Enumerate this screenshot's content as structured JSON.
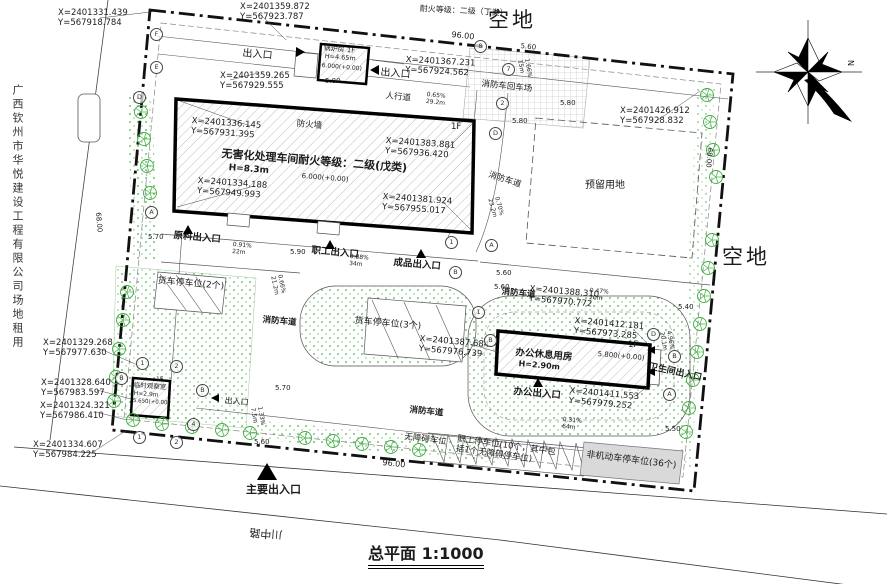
{
  "meta": {
    "scale": "1:1000"
  },
  "colors": {
    "line": "#1a1a1a",
    "tree_green": "#3fae3f",
    "grass_dot": "#4caf50",
    "gray_parking": "#d9d9d9",
    "hatch": "#adadad"
  },
  "icons": [
    "north-compass-icon",
    "entrance-arrow-icon",
    "tree-icon",
    "axis-bubble-icon"
  ],
  "texts": [
    {
      "n": "coord-top-left",
      "t": "X=2401331.439\nY=567918.784",
      "x": 58,
      "y": 8,
      "s": 8.5
    },
    {
      "n": "coord-top-2",
      "t": "X=2401359.872\nY=567923.787",
      "x": 240,
      "y": 2,
      "s": 8.5
    },
    {
      "n": "fire-rating-note",
      "t": "耐火等级：二级（丁类）",
      "x": 420,
      "y": 4,
      "s": 8,
      "r": 3
    },
    {
      "n": "vacant-land-top",
      "t": "空地",
      "x": 488,
      "y": 8,
      "s": 21,
      "sp": 3
    },
    {
      "n": "dim-96-top",
      "t": "96.00",
      "x": 452,
      "y": 30,
      "s": 8,
      "r": 6
    },
    {
      "n": "dim-560-top",
      "t": "5.60",
      "x": 521,
      "y": 42,
      "s": 7,
      "r": 6
    },
    {
      "n": "entrance-nw-label",
      "t": "出入口",
      "x": 243,
      "y": 48,
      "s": 10,
      "r": 5
    },
    {
      "n": "boiler-name",
      "t": "锅炉房 1F",
      "x": 324,
      "y": 44,
      "s": 7,
      "r": 5
    },
    {
      "n": "boiler-height",
      "t": "H=4.65m",
      "x": 325,
      "y": 53,
      "s": 6.5,
      "r": 5
    },
    {
      "n": "boiler-elevation",
      "t": "6.000(+0.00)",
      "x": 322,
      "y": 62,
      "s": 6,
      "r": 5
    },
    {
      "n": "coord-boiler",
      "t": "X=2401367.231\nY=567924.562",
      "x": 406,
      "y": 55,
      "s": 8.5,
      "r": 3
    },
    {
      "n": "entrance-n2-label",
      "t": "出入口",
      "x": 381,
      "y": 67,
      "s": 10,
      "r": 5
    },
    {
      "n": "fire-truck-turnaround",
      "t": "消防车回车场",
      "x": 482,
      "y": 79,
      "s": 8.5,
      "r": 6
    },
    {
      "n": "walkway-label",
      "t": "人行道",
      "x": 386,
      "y": 91,
      "s": 8.5,
      "r": 6
    },
    {
      "n": "slope-walkway",
      "t": "0.65%\n29.2m",
      "x": 427,
      "y": 91,
      "s": 6,
      "r": 6
    },
    {
      "n": "coord-axis-d",
      "t": "X=2401359.265\nY=567929.555",
      "x": 220,
      "y": 71,
      "s": 8.5
    },
    {
      "n": "dim-580-a",
      "t": "5.80",
      "x": 325,
      "y": 77,
      "s": 7
    },
    {
      "n": "dim-580-b",
      "t": "5.80",
      "x": 560,
      "y": 99,
      "s": 7
    },
    {
      "n": "dim-580-c",
      "t": "5.80",
      "x": 512,
      "y": 117,
      "s": 7
    },
    {
      "n": "slope-turnaround",
      "t": "1.66%\n15m",
      "x": 530,
      "y": 58,
      "s": 6,
      "r": 80
    },
    {
      "n": "firewall-label",
      "t": "防火墙",
      "x": 297,
      "y": 119,
      "s": 8.5,
      "r": 5
    },
    {
      "n": "main-building-floor",
      "t": "1F",
      "x": 451,
      "y": 122,
      "s": 8.5
    },
    {
      "n": "coord-main-1",
      "t": "X=2401336.145\nY=567931.395",
      "x": 192,
      "y": 116,
      "s": 8.5,
      "r": 4
    },
    {
      "n": "main-building-name",
      "t": "无害化处理车间耐火等级：二级(戊类)",
      "x": 222,
      "y": 148,
      "s": 11,
      "r": 4.5,
      "b": 1
    },
    {
      "n": "main-building-height",
      "t": "H=8.3m",
      "x": 229,
      "y": 163,
      "s": 9,
      "r": 4.5,
      "b": 1
    },
    {
      "n": "main-building-elevation",
      "t": "6.000(+0.00)",
      "x": 302,
      "y": 172,
      "s": 7,
      "r": 4.5
    },
    {
      "n": "coord-main-2",
      "t": "X=2401383.881\nY=567936.420",
      "x": 386,
      "y": 136,
      "s": 8.5,
      "r": 4
    },
    {
      "n": "coord-main-3",
      "t": "X=2401334.188\nY=567949.993",
      "x": 198,
      "y": 176,
      "s": 8.5,
      "r": 4
    },
    {
      "n": "coord-main-4",
      "t": "X=2401381.924\nY=567955.017",
      "x": 383,
      "y": 192,
      "s": 8.5,
      "r": 4
    },
    {
      "n": "fire-lane-east",
      "t": "消防车道",
      "x": 490,
      "y": 170,
      "s": 8.5,
      "r": 18
    },
    {
      "n": "slope-east",
      "t": "0.70%\n23.2m",
      "x": 500,
      "y": 196,
      "s": 6,
      "r": 75
    },
    {
      "n": "reserved-land",
      "t": "预留用地",
      "x": 585,
      "y": 180,
      "s": 10
    },
    {
      "n": "coord-right",
      "t": "X=2401426.912\nY=567928.832",
      "x": 620,
      "y": 106,
      "s": 8.5
    },
    {
      "n": "vacant-land-right",
      "t": "空地",
      "x": 722,
      "y": 245,
      "s": 21,
      "sp": 3
    },
    {
      "n": "dim-68-right",
      "t": "68.00",
      "x": 714,
      "y": 148,
      "s": 7,
      "r": 95
    },
    {
      "n": "dim-68-left",
      "t": "68.00",
      "x": 102,
      "y": 212,
      "s": 7,
      "r": 85
    },
    {
      "n": "dim-570-a",
      "t": "5.70",
      "x": 148,
      "y": 233,
      "s": 7
    },
    {
      "n": "raw-material-entrance",
      "t": "原料出入口",
      "x": 174,
      "y": 230,
      "s": 9.5,
      "r": 5,
      "b": 1
    },
    {
      "n": "slope-a",
      "t": "0.91%\n22m",
      "x": 233,
      "y": 241,
      "s": 6,
      "r": 5
    },
    {
      "n": "dim-590",
      "t": "5.90",
      "x": 290,
      "y": 248,
      "s": 7
    },
    {
      "n": "staff-entrance",
      "t": "职工出入口",
      "x": 312,
      "y": 245,
      "s": 9.5,
      "r": 5,
      "b": 1
    },
    {
      "n": "slope-b",
      "t": "0.88%\n34m",
      "x": 350,
      "y": 253,
      "s": 6,
      "r": 5
    },
    {
      "n": "product-entrance",
      "t": "成品出入口",
      "x": 394,
      "y": 257,
      "s": 9.5,
      "r": 5,
      "b": 1
    },
    {
      "n": "dim-560-b",
      "t": "5.60",
      "x": 496,
      "y": 269,
      "s": 7
    },
    {
      "n": "dim-560-c",
      "t": "5.60",
      "x": 494,
      "y": 283,
      "s": 7
    },
    {
      "n": "fire-lane-center",
      "t": "消防车道",
      "x": 502,
      "y": 287,
      "s": 8.5,
      "r": 5,
      "b": 1
    },
    {
      "n": "coord-fire-lane",
      "t": "X=2401388.310\nY=567970.772",
      "x": 530,
      "y": 284,
      "s": 8.5,
      "r": 5
    },
    {
      "n": "slope-c",
      "t": "0.47%\n20m",
      "x": 590,
      "y": 287,
      "s": 6,
      "r": 5
    },
    {
      "n": "truck-parking-2",
      "t": "货车停车位(2个)",
      "x": 158,
      "y": 276,
      "s": 9,
      "r": 5
    },
    {
      "n": "slope-d",
      "t": "0.66%\n21.2m",
      "x": 283,
      "y": 274,
      "s": 6,
      "r": 78
    },
    {
      "n": "fire-lane-west",
      "t": "消防车道",
      "x": 263,
      "y": 315,
      "s": 8.5,
      "r": 5,
      "b": 1
    },
    {
      "n": "truck-parking-3",
      "t": "货车停车位(3个)",
      "x": 355,
      "y": 316,
      "s": 9,
      "r": 5
    },
    {
      "n": "coord-truck3",
      "t": "X=2401387.684\nY=567976.739",
      "x": 420,
      "y": 334,
      "s": 8.5,
      "r": 5
    },
    {
      "n": "coord-office-1",
      "t": "X=2401412.181\nY=567973.285",
      "x": 575,
      "y": 316,
      "s": 8.5,
      "r": 5
    },
    {
      "n": "office-building-name",
      "t": "办公休息用房",
      "x": 516,
      "y": 347,
      "s": 9.5,
      "r": 5,
      "b": 1
    },
    {
      "n": "office-building-height",
      "t": "H=2.90m",
      "x": 519,
      "y": 359,
      "s": 8,
      "r": 5,
      "b": 1
    },
    {
      "n": "office-elevation",
      "t": "5.800(+0.00)",
      "x": 598,
      "y": 350,
      "s": 7,
      "r": 5
    },
    {
      "n": "office-floor",
      "t": "1F",
      "x": 628,
      "y": 340,
      "s": 8.5
    },
    {
      "n": "toilet-entrance",
      "t": "卫生间出入口",
      "x": 650,
      "y": 362,
      "s": 9,
      "r": 12,
      "b": 1
    },
    {
      "n": "office-entrance",
      "t": "办公出入口",
      "x": 514,
      "y": 386,
      "s": 9.5,
      "r": 5,
      "b": 1
    },
    {
      "n": "coord-office-2",
      "t": "X=2401411.553\nY=567979.252",
      "x": 570,
      "y": 386,
      "s": 8.5,
      "r": 5
    },
    {
      "n": "dim-540",
      "t": "5.40",
      "x": 678,
      "y": 303,
      "s": 7
    },
    {
      "n": "slope-f",
      "t": "4.96%\n20.1m",
      "x": 672,
      "y": 330,
      "s": 6,
      "r": 80
    },
    {
      "n": "dim-550",
      "t": "5.50",
      "x": 665,
      "y": 425,
      "s": 7
    },
    {
      "n": "coord-left-1",
      "t": "X=2401329.268\nY=567977.630",
      "x": 43,
      "y": 338,
      "s": 8.5
    },
    {
      "n": "coord-left-2",
      "t": "X=2401328.640\nY=567983.597",
      "x": 41,
      "y": 378,
      "s": 8.5
    },
    {
      "n": "coord-left-3",
      "t": "X=2401324.321\nY=567986.410",
      "x": 40,
      "y": 401,
      "s": 8.5
    },
    {
      "n": "coord-left-4",
      "t": "X=2401334.607\nY=567984.225",
      "x": 33,
      "y": 440,
      "s": 8.5
    },
    {
      "n": "guard-floor",
      "t": "1F",
      "x": 156,
      "y": 376,
      "s": 6
    },
    {
      "n": "guard-name",
      "t": "临时观察室",
      "x": 134,
      "y": 382,
      "s": 6.5,
      "r": 4
    },
    {
      "n": "guard-height",
      "t": "H=2.9m",
      "x": 134,
      "y": 390,
      "s": 6,
      "r": 4
    },
    {
      "n": "guard-elevation",
      "t": "5.650(+0.00)",
      "x": 133,
      "y": 398,
      "s": 5.5,
      "r": 4
    },
    {
      "n": "entrance-west-label",
      "t": "出入口",
      "x": 225,
      "y": 396,
      "s": 8,
      "r": 5
    },
    {
      "n": "dim-570-b",
      "t": "5.70",
      "x": 275,
      "y": 384,
      "s": 7
    },
    {
      "n": "slope-g",
      "t": "1.33%\n7.5m",
      "x": 263,
      "y": 406,
      "s": 6,
      "r": 80
    },
    {
      "n": "dim-560-d",
      "t": "5.60",
      "x": 254,
      "y": 438,
      "s": 7
    },
    {
      "n": "fire-lane-south",
      "t": "消防车道",
      "x": 410,
      "y": 405,
      "s": 8.5,
      "r": 6,
      "b": 1
    },
    {
      "n": "accessible-parking",
      "t": "无障碍车位",
      "x": 405,
      "y": 432,
      "s": 8.5,
      "r": 7
    },
    {
      "n": "staff-parking",
      "t": "职工停车位(10个，其中包\n括1个无障碍停车位)",
      "x": 458,
      "y": 434,
      "s": 8.5,
      "r": 8
    },
    {
      "n": "bike-parking",
      "t": "非机动车停车位(36个)",
      "x": 587,
      "y": 450,
      "s": 9,
      "r": 7
    },
    {
      "n": "slope-h",
      "t": "0.31%\n64m",
      "x": 563,
      "y": 416,
      "s": 6,
      "r": 5
    },
    {
      "n": "dim-96-bottom",
      "t": "96.00",
      "x": 383,
      "y": 458,
      "s": 8,
      "r": 6
    },
    {
      "n": "main-entrance-label",
      "t": "主要出入口",
      "x": 246,
      "y": 484,
      "s": 11,
      "b": 1
    },
    {
      "n": "road-name",
      "t": "川中路",
      "x": 282,
      "y": 540,
      "s": 11,
      "r": 184
    },
    {
      "n": "plan-title",
      "t": "总平面 1:1000",
      "x": 368,
      "y": 545,
      "s": 16,
      "b": 1,
      "u": 1
    },
    {
      "n": "company-strip",
      "t": "广西钦州市华悦建设工程有限公司场地租用",
      "x": 10,
      "y": 84,
      "s": 11,
      "v": 1
    },
    {
      "n": "north-label",
      "t": "N",
      "x": 855,
      "y": 60,
      "s": 8,
      "r": 90
    }
  ],
  "axis_bubbles": [
    {
      "t": "F",
      "x": 150,
      "y": 28
    },
    {
      "t": "E",
      "x": 150,
      "y": 61
    },
    {
      "t": "D",
      "x": 133,
      "y": 91
    },
    {
      "t": "A",
      "x": 145,
      "y": 206
    },
    {
      "t": "8",
      "x": 474,
      "y": 40
    },
    {
      "t": "7",
      "x": 502,
      "y": 63
    },
    {
      "t": "2",
      "x": 496,
      "y": 97
    },
    {
      "t": "D",
      "x": 489,
      "y": 127
    },
    {
      "t": "1",
      "x": 445,
      "y": 236
    },
    {
      "t": "A",
      "x": 485,
      "y": 239
    },
    {
      "t": "B",
      "x": 449,
      "y": 266
    },
    {
      "t": "1",
      "x": 472,
      "y": 306
    },
    {
      "t": "B",
      "x": 484,
      "y": 334
    },
    {
      "t": "D",
      "x": 647,
      "y": 328
    },
    {
      "t": "B",
      "x": 668,
      "y": 350
    },
    {
      "t": "A",
      "x": 663,
      "y": 388
    },
    {
      "t": "1",
      "x": 136,
      "y": 357
    },
    {
      "t": "2",
      "x": 170,
      "y": 360
    },
    {
      "t": "B",
      "x": 115,
      "y": 372
    },
    {
      "t": "B",
      "x": 196,
      "y": 384
    },
    {
      "t": "4",
      "x": 187,
      "y": 418
    },
    {
      "t": "1",
      "x": 133,
      "y": 431
    },
    {
      "t": "2",
      "x": 170,
      "y": 436
    }
  ],
  "entrance_markers": [
    {
      "d": "right",
      "x": 296,
      "y": 47,
      "s": 10
    },
    {
      "d": "left",
      "x": 370,
      "y": 65,
      "s": 10
    },
    {
      "d": "up",
      "x": 183,
      "y": 225,
      "s": 11
    },
    {
      "d": "up",
      "x": 325,
      "y": 240,
      "s": 11
    },
    {
      "d": "up",
      "x": 416,
      "y": 249,
      "s": 11
    },
    {
      "d": "up",
      "x": 533,
      "y": 378,
      "s": 11
    },
    {
      "d": "left",
      "x": 647,
      "y": 346,
      "s": 9
    },
    {
      "d": "left",
      "x": 647,
      "y": 368,
      "s": 9
    },
    {
      "d": "left",
      "x": 211,
      "y": 394,
      "s": 9
    },
    {
      "d": "up",
      "x": 257,
      "y": 463,
      "s": 20
    }
  ],
  "trees": [
    [
      141,
      112
    ],
    [
      144,
      139
    ],
    [
      147,
      166
    ],
    [
      150,
      193
    ],
    [
      127,
      292
    ],
    [
      123,
      320
    ],
    [
      119,
      349
    ],
    [
      116,
      377
    ],
    [
      114,
      401
    ],
    [
      133,
      420
    ],
    [
      162,
      424
    ],
    [
      192,
      427
    ],
    [
      222,
      430
    ],
    [
      250,
      433
    ],
    [
      305,
      438
    ],
    [
      333,
      441
    ],
    [
      362,
      444
    ],
    [
      391,
      447
    ],
    [
      419,
      450
    ],
    [
      707,
      95
    ],
    [
      710,
      122
    ],
    [
      713,
      150
    ],
    [
      716,
      177
    ],
    [
      712,
      240
    ],
    [
      708,
      268
    ],
    [
      704,
      296
    ],
    [
      700,
      324
    ],
    [
      697,
      352
    ],
    [
      693,
      380
    ],
    [
      689,
      408
    ],
    [
      686,
      432
    ]
  ]
}
